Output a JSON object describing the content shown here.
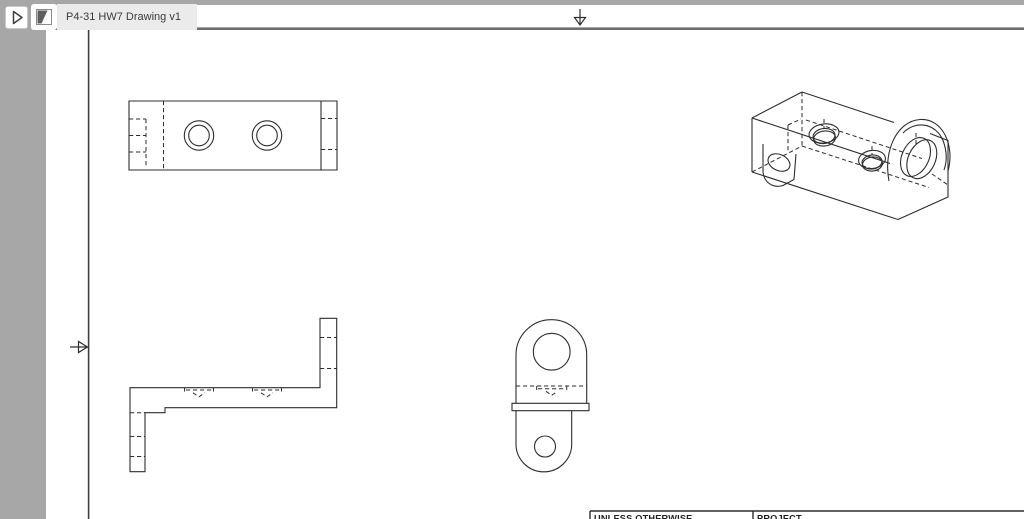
{
  "app": {
    "expand_button": {
      "icon": "play-right-icon"
    },
    "tab": {
      "icon": "drawing-sheet-icon",
      "label": "P4-31 HW7 Drawing v1"
    }
  },
  "colors": {
    "chrome_gray": "#a7a7a7",
    "tab_background": "#ebebeb",
    "tab_text": "#3b3b3b",
    "drawing_line": "#2e2e2e",
    "canvas_background": "#ffffff"
  },
  "drawing": {
    "chrome": {
      "divider_d": "M46,28.7 H1024",
      "border_d": "M88.6,29.8 V519",
      "arrow_top_d": "M580,9 V25 M574.5,17.5 H585.5 L580,25 Z",
      "arrow_left_d": "M70,347 H87.5 M78.5,341.5 V352.5 L87.5,347 Z"
    },
    "views": {
      "top": {
        "solid": [
          "M129,101 H337 V170 H129 Z",
          "M321,101 V170"
        ],
        "dashed": [
          "M163.5,101 V170",
          "M129,119 H146",
          "M129,135.5 H146",
          "M129,152 H146",
          "M146,119 V167",
          "M321,118.5 H337",
          "M321,149.5 H337"
        ],
        "circles": [
          [
            199,
            135.5,
            14.7
          ],
          [
            199,
            135.5,
            10.3
          ],
          [
            267,
            135.5,
            14.7
          ],
          [
            267,
            135.5,
            10.3
          ]
        ]
      },
      "front": {
        "solid": [
          "M130,387.7 H320 V318.3 H336.7 V407.7 H165 V412.7 H145 V471.7 H130 Z"
        ],
        "dashed": [
          "M320,337.5 H336.7",
          "M320,368.5 H336.7",
          "M130,412.7 H145",
          "M130,436.5 H145",
          "M130,456.5 H145",
          "M184.5,387.7 V391.5",
          "M213.5,387.7 V391.5",
          "M186,390 H212",
          "M193,392.8 L199,396.8 L205,392.8",
          "M252.5,387.7 V391.5",
          "M281.5,387.7 V391.5",
          "M254,390 H280",
          "M261,392.8 L267,396.8 L273,392.8"
        ]
      },
      "side": {
        "solid": [
          "M516,403.3 V355 A35.35,35.35 0 0 1 586.7,355 V403.3",
          "M512,403.3 H589 V410.7 H512 Z",
          "M571.7,410.7 V444 A27.85,27.85 0 0 1 516,444 V410.7"
        ],
        "dashed": [
          "M516,386 H586.7",
          "M536.7,386 V390",
          "M566.7,386 V390",
          "M538,388.7 H565",
          "M546,391.3 L551.7,395.3 L557.4,391.3"
        ],
        "circles": [
          [
            551.7,
            351.7,
            18.4
          ],
          [
            545,
            446.5,
            10.5
          ]
        ]
      },
      "iso": {
        "solid": [
          "M752,118 L802,92",
          "M752,118 V172",
          "M752,118 L890,163.5",
          "M802,92 L894,122.5",
          "M752,172 L898,219.5",
          "M930,133.5 L948,140.5 V197 L898,219.5",
          "M889,181 C883,151 897,121 920,119.5 C943,118 955,146 948,171",
          "M903,133 C916,119.5 936,123.5 943,140.5 C947,151 947,161.5 944,170",
          "M763,144 V172 C764,182.5 773,188.5 783,185.5 L794,179.5",
          "M794,179.5 L796,154"
        ],
        "dashed": [
          "M802,92 V147",
          "M752,172 L802,146",
          "M802,146 L929,187.5",
          "M806,120 L922,158.5",
          "M788,125 V152",
          "M788,125 L801,119",
          "M932,174 L948,185",
          "M824,119 V128",
          "M872,146 V155",
          "M916,133 V144"
        ],
        "ellipses": [
          [
            824,
            133.5,
            15,
            9.5,
            -8
          ],
          [
            824,
            136,
            11,
            7.5,
            -8
          ],
          [
            824.5,
            138.5,
            11,
            7.5,
            -8
          ],
          [
            872,
            159.5,
            13.5,
            9,
            -8
          ],
          [
            872,
            162,
            10,
            7,
            -8
          ],
          [
            872.5,
            164,
            10,
            7,
            -8
          ],
          [
            915.5,
            157,
            20.5,
            13.5,
            -65
          ],
          [
            921.8,
            159.2,
            20.5,
            13.5,
            -65
          ],
          [
            779,
            162.5,
            11.5,
            8,
            25
          ]
        ]
      }
    },
    "title_block": {
      "solid": [
        "M590,511 H1024",
        "M590,511 V519",
        "M753,511 V519"
      ],
      "cells": [
        {
          "label": "UNLESS OTHERWISE"
        },
        {
          "label": "PROJECT"
        }
      ]
    }
  }
}
